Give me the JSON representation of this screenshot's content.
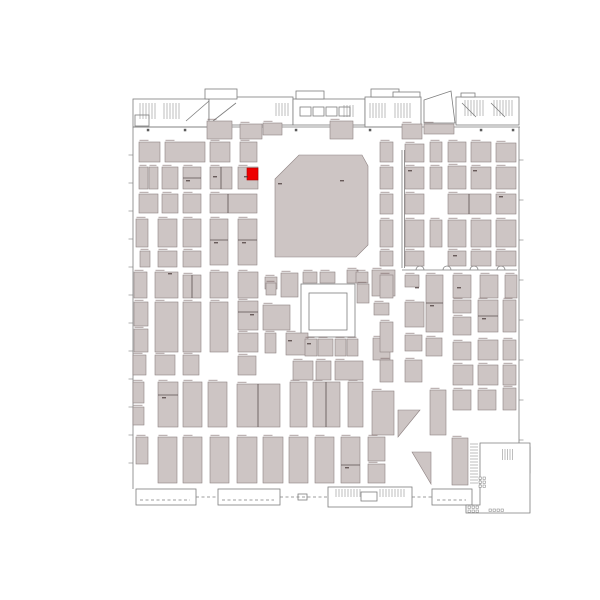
{
  "meta": {
    "view": "exhibit-hall-floor-plan",
    "canvas": {
      "w": 600,
      "h": 600
    }
  },
  "colors": {
    "background": "#ffffff",
    "booth_fill": "#cdc5c4",
    "booth_stroke": "#8e8282",
    "structure_stroke": "#7d7d7d",
    "divider_stroke": "#5a4f4f",
    "highlight_fill": "#ee0000",
    "highlight_stroke": "#b00000",
    "speck": "rgba(110,88,88,0.5)",
    "inner_speck": "rgba(70,55,55,0.75)",
    "dot": "#5c5c5c"
  },
  "plan": {
    "highlight_booth": [
      247,
      168,
      11,
      12
    ],
    "booths": [
      [
        139,
        142,
        21,
        20
      ],
      [
        165,
        142,
        40,
        20
      ],
      [
        210,
        142,
        20,
        20
      ],
      [
        240,
        142,
        17,
        20
      ],
      [
        139,
        167,
        9,
        22
      ],
      [
        149,
        167,
        9,
        22
      ],
      [
        162,
        167,
        16,
        22
      ],
      [
        183,
        167,
        18,
        22
      ],
      [
        210,
        167,
        22,
        22
      ],
      [
        238,
        167,
        20,
        22
      ],
      [
        139,
        194,
        19,
        19
      ],
      [
        162,
        194,
        16,
        19
      ],
      [
        183,
        194,
        18,
        19
      ],
      [
        210,
        194,
        47,
        19
      ],
      [
        136,
        219,
        12,
        28
      ],
      [
        158,
        219,
        19,
        28
      ],
      [
        183,
        219,
        18,
        28
      ],
      [
        210,
        219,
        18,
        46
      ],
      [
        238,
        219,
        19,
        46
      ],
      [
        140,
        251,
        10,
        16
      ],
      [
        158,
        251,
        19,
        16
      ],
      [
        183,
        251,
        18,
        16
      ],
      [
        134,
        272,
        13,
        26
      ],
      [
        155,
        272,
        23,
        26
      ],
      [
        183,
        275,
        18,
        23
      ],
      [
        210,
        272,
        18,
        26
      ],
      [
        238,
        272,
        20,
        26
      ],
      [
        265,
        277,
        12,
        12
      ],
      [
        134,
        302,
        14,
        24
      ],
      [
        134,
        329,
        14,
        23
      ],
      [
        155,
        302,
        23,
        50
      ],
      [
        183,
        302,
        18,
        50
      ],
      [
        210,
        302,
        18,
        50
      ],
      [
        238,
        301,
        20,
        29
      ],
      [
        238,
        333,
        20,
        19
      ],
      [
        263,
        305,
        27,
        25
      ],
      [
        265,
        333,
        11,
        20
      ],
      [
        133,
        355,
        13,
        20
      ],
      [
        155,
        355,
        20,
        20
      ],
      [
        183,
        355,
        16,
        20
      ],
      [
        238,
        356,
        18,
        19
      ],
      [
        133,
        382,
        11,
        21
      ],
      [
        133,
        407,
        11,
        18
      ],
      [
        158,
        382,
        20,
        45
      ],
      [
        183,
        382,
        19,
        45
      ],
      [
        208,
        382,
        19,
        45
      ],
      [
        237,
        384,
        43,
        43
      ],
      [
        290,
        382,
        17,
        45
      ],
      [
        313,
        382,
        27,
        45
      ],
      [
        348,
        382,
        15,
        45
      ],
      [
        372,
        391,
        22,
        44
      ],
      [
        136,
        437,
        12,
        27
      ],
      [
        158,
        437,
        19,
        46
      ],
      [
        183,
        437,
        19,
        46
      ],
      [
        210,
        437,
        19,
        46
      ],
      [
        237,
        437,
        20,
        46
      ],
      [
        263,
        437,
        20,
        46
      ],
      [
        289,
        437,
        19,
        46
      ],
      [
        315,
        437,
        19,
        46
      ],
      [
        341,
        437,
        19,
        46
      ],
      [
        368,
        437,
        17,
        24
      ],
      [
        368,
        464,
        17,
        19
      ],
      [
        266,
        283,
        10,
        12
      ],
      [
        281,
        273,
        17,
        24
      ],
      [
        303,
        272,
        14,
        11
      ],
      [
        320,
        272,
        15,
        11
      ],
      [
        347,
        270,
        11,
        13
      ],
      [
        356,
        272,
        12,
        11
      ],
      [
        357,
        284,
        12,
        19
      ],
      [
        372,
        270,
        23,
        26
      ],
      [
        374,
        303,
        15,
        12
      ],
      [
        373,
        338,
        17,
        22
      ],
      [
        286,
        333,
        22,
        22
      ],
      [
        305,
        339,
        12,
        17
      ],
      [
        318,
        339,
        15,
        17
      ],
      [
        335,
        339,
        11,
        17
      ],
      [
        347,
        339,
        11,
        17
      ],
      [
        293,
        361,
        20,
        19
      ],
      [
        316,
        361,
        15,
        19
      ],
      [
        335,
        361,
        28,
        19
      ],
      [
        380,
        142,
        13,
        20
      ],
      [
        405,
        144,
        19,
        18
      ],
      [
        430,
        142,
        12,
        20
      ],
      [
        448,
        142,
        18,
        20
      ],
      [
        471,
        142,
        20,
        20
      ],
      [
        496,
        143,
        20,
        19
      ],
      [
        380,
        167,
        13,
        22
      ],
      [
        405,
        167,
        19,
        22
      ],
      [
        430,
        167,
        12,
        22
      ],
      [
        448,
        166,
        18,
        23
      ],
      [
        471,
        167,
        20,
        22
      ],
      [
        496,
        167,
        20,
        22
      ],
      [
        380,
        194,
        13,
        20
      ],
      [
        405,
        194,
        19,
        20
      ],
      [
        448,
        194,
        43,
        20
      ],
      [
        496,
        194,
        20,
        20
      ],
      [
        380,
        220,
        13,
        27
      ],
      [
        405,
        220,
        19,
        27
      ],
      [
        430,
        220,
        12,
        27
      ],
      [
        448,
        220,
        18,
        27
      ],
      [
        471,
        220,
        20,
        27
      ],
      [
        496,
        220,
        20,
        27
      ],
      [
        380,
        251,
        13,
        15
      ],
      [
        405,
        251,
        19,
        15
      ],
      [
        448,
        251,
        18,
        15
      ],
      [
        471,
        251,
        20,
        15
      ],
      [
        496,
        251,
        20,
        15
      ],
      [
        380,
        275,
        13,
        23
      ],
      [
        405,
        275,
        14,
        12
      ],
      [
        426,
        275,
        17,
        57
      ],
      [
        453,
        275,
        18,
        23
      ],
      [
        480,
        275,
        18,
        23
      ],
      [
        505,
        275,
        12,
        23
      ],
      [
        380,
        322,
        13,
        30
      ],
      [
        405,
        302,
        19,
        25
      ],
      [
        453,
        300,
        18,
        13
      ],
      [
        453,
        317,
        18,
        18
      ],
      [
        478,
        300,
        20,
        32
      ],
      [
        503,
        300,
        13,
        32
      ],
      [
        405,
        335,
        17,
        16
      ],
      [
        426,
        338,
        16,
        18
      ],
      [
        453,
        342,
        18,
        18
      ],
      [
        478,
        340,
        20,
        20
      ],
      [
        503,
        340,
        13,
        20
      ],
      [
        380,
        360,
        13,
        22
      ],
      [
        405,
        360,
        17,
        22
      ],
      [
        453,
        365,
        20,
        20
      ],
      [
        478,
        365,
        20,
        20
      ],
      [
        503,
        365,
        13,
        20
      ],
      [
        430,
        390,
        16,
        45
      ],
      [
        453,
        390,
        18,
        20
      ],
      [
        478,
        390,
        18,
        20
      ],
      [
        503,
        388,
        13,
        22
      ],
      [
        452,
        438,
        16,
        47
      ],
      [
        207,
        121,
        25,
        18
      ],
      [
        240,
        124,
        22,
        15
      ],
      [
        263,
        123,
        19,
        12
      ],
      [
        330,
        121,
        23,
        18
      ],
      [
        402,
        124,
        20,
        15
      ],
      [
        424,
        124,
        30,
        10
      ]
    ],
    "booth_polys": [
      [
        [
          275,
          179
        ],
        [
          299,
          155
        ],
        [
          362,
          155
        ],
        [
          368,
          166
        ],
        [
          368,
          245
        ],
        [
          356,
          257
        ],
        [
          275,
          257
        ]
      ],
      [
        [
          398,
          410
        ],
        [
          420,
          410
        ],
        [
          398,
          437
        ]
      ],
      [
        [
          412,
          452
        ],
        [
          431,
          452
        ],
        [
          431,
          484
        ]
      ]
    ],
    "outlines": [
      [
        133,
        99,
        76,
        28
      ],
      [
        209,
        97,
        84,
        28
      ],
      [
        293,
        99,
        72,
        26
      ],
      [
        365,
        97,
        56,
        30
      ],
      [
        456,
        97,
        63,
        28
      ],
      [
        205,
        89,
        32,
        10
      ],
      [
        296,
        91,
        28,
        8
      ],
      [
        371,
        89,
        28,
        8
      ],
      [
        393,
        92,
        27,
        5
      ],
      [
        461,
        93,
        14,
        4
      ],
      [
        135,
        115,
        14,
        11
      ],
      [
        300,
        107,
        11,
        9
      ],
      [
        313,
        107,
        11,
        9
      ],
      [
        326,
        107,
        11,
        9
      ],
      [
        339,
        107,
        11,
        9
      ],
      [
        301,
        284,
        54,
        53
      ],
      [
        309,
        293,
        38,
        37
      ],
      [
        497,
        447,
        18,
        14
      ],
      [
        515,
        447,
        15,
        14
      ],
      [
        497,
        461,
        12,
        12
      ],
      [
        509,
        461,
        21,
        12
      ],
      [
        484,
        475,
        12,
        16
      ],
      [
        500,
        473,
        16,
        18
      ],
      [
        136,
        489,
        60,
        16
      ],
      [
        218,
        489,
        62,
        16
      ],
      [
        328,
        487,
        84,
        20
      ],
      [
        361,
        492,
        16,
        9
      ],
      [
        432,
        489,
        40,
        16
      ],
      [
        298,
        494,
        9,
        6
      ]
    ],
    "outline_polys": [
      [
        [
          424,
          100
        ],
        [
          451,
          91
        ],
        [
          455,
          123
        ],
        [
          424,
          123
        ]
      ],
      [
        [
          480,
          443
        ],
        [
          530,
          443
        ],
        [
          530,
          513
        ],
        [
          466,
          513
        ],
        [
          466,
          505
        ],
        [
          480,
          505
        ]
      ]
    ],
    "lines": [
      [
        133,
        127,
        133,
        489
      ],
      [
        519,
        127,
        519,
        443
      ],
      [
        133,
        127,
        520,
        127
      ],
      [
        186,
        121,
        209,
        101
      ],
      [
        213,
        121,
        236,
        103
      ],
      [
        462,
        103,
        476,
        117
      ],
      [
        491,
        103,
        505,
        117
      ],
      [
        402,
        150,
        402,
        268
      ],
      [
        404.5,
        150,
        404.5,
        268
      ],
      [
        402,
        270,
        517,
        270
      ]
    ],
    "dashes": [
      [
        196,
        497,
        218,
        497
      ],
      [
        280,
        497,
        328,
        497
      ],
      [
        412,
        497,
        432,
        497
      ],
      [
        140,
        500,
        190,
        500
      ],
      [
        222,
        500,
        274,
        500
      ],
      [
        437,
        500,
        466,
        500
      ]
    ],
    "dividers": [
      [
        183,
        178,
        201,
        178
      ],
      [
        221,
        167,
        221,
        189
      ],
      [
        228,
        194,
        228,
        213
      ],
      [
        210,
        240,
        228,
        240
      ],
      [
        238,
        240,
        257,
        240
      ],
      [
        158,
        395,
        178,
        395
      ],
      [
        341,
        465,
        360,
        465
      ],
      [
        469,
        194,
        469,
        214
      ],
      [
        426,
        303,
        443,
        303
      ],
      [
        326,
        382,
        326,
        427
      ],
      [
        258,
        384,
        258,
        427
      ],
      [
        238,
        312,
        258,
        312
      ],
      [
        478,
        316,
        498,
        316
      ],
      [
        192,
        275,
        192,
        298
      ]
    ],
    "hatches": [
      [
        137,
        103,
        20,
        16,
        3,
        "v"
      ],
      [
        161,
        103,
        20,
        16,
        3,
        "v"
      ],
      [
        273,
        103,
        17,
        13,
        3,
        "v"
      ],
      [
        341,
        105,
        15,
        12,
        3,
        "v"
      ],
      [
        367,
        103,
        19,
        15,
        3,
        "v"
      ],
      [
        392,
        103,
        19,
        15,
        3,
        "v"
      ],
      [
        462,
        100,
        24,
        16,
        3,
        "v"
      ],
      [
        491,
        100,
        24,
        16,
        3,
        "v"
      ],
      [
        470,
        441,
        8,
        44,
        3,
        "h"
      ],
      [
        500,
        449,
        13,
        11,
        2.5,
        "v"
      ],
      [
        333,
        489,
        28,
        8,
        3,
        "v"
      ],
      [
        377,
        489,
        28,
        8,
        3,
        "v"
      ]
    ],
    "arcs": [
      [
        420,
        270,
        4
      ],
      [
        447,
        270,
        4
      ],
      [
        474,
        270,
        4
      ],
      [
        501,
        270,
        4
      ]
    ],
    "dots": [
      [
        148,
        130
      ],
      [
        185,
        130
      ],
      [
        222,
        130
      ],
      [
        259,
        130
      ],
      [
        296,
        130
      ],
      [
        333,
        130
      ],
      [
        370,
        130
      ],
      [
        407,
        130
      ],
      [
        444,
        130
      ],
      [
        481,
        130
      ],
      [
        513,
        130
      ]
    ],
    "tiny_squares": [
      [
        479,
        477
      ],
      [
        483,
        477
      ],
      [
        479,
        481
      ],
      [
        483,
        481
      ],
      [
        479,
        485
      ],
      [
        483,
        485
      ],
      [
        468,
        506
      ],
      [
        472,
        506
      ],
      [
        476,
        506
      ],
      [
        468,
        510
      ],
      [
        472,
        510
      ],
      [
        476,
        510
      ],
      [
        489,
        509
      ],
      [
        493,
        509
      ],
      [
        497,
        509
      ],
      [
        501,
        509
      ]
    ],
    "left_ticks": [
      155,
      183,
      211,
      239,
      267,
      295,
      323,
      351,
      379,
      407,
      435,
      463
    ],
    "right_ticks": [
      160,
      200,
      240,
      280,
      320,
      360,
      400,
      440
    ],
    "inner_specks": [
      [
        186,
        180
      ],
      [
        214,
        242
      ],
      [
        242,
        242
      ],
      [
        162,
        397
      ],
      [
        345,
        467
      ],
      [
        430,
        305
      ],
      [
        482,
        318
      ],
      [
        250,
        314
      ],
      [
        415,
        287
      ],
      [
        457,
        287
      ],
      [
        288,
        340
      ],
      [
        307,
        343
      ],
      [
        340,
        180
      ],
      [
        408,
        170
      ],
      [
        473,
        170
      ],
      [
        499,
        196
      ],
      [
        453,
        255
      ],
      [
        168,
        273
      ],
      [
        213,
        176
      ],
      [
        244,
        176
      ],
      [
        278,
        183
      ]
    ]
  }
}
